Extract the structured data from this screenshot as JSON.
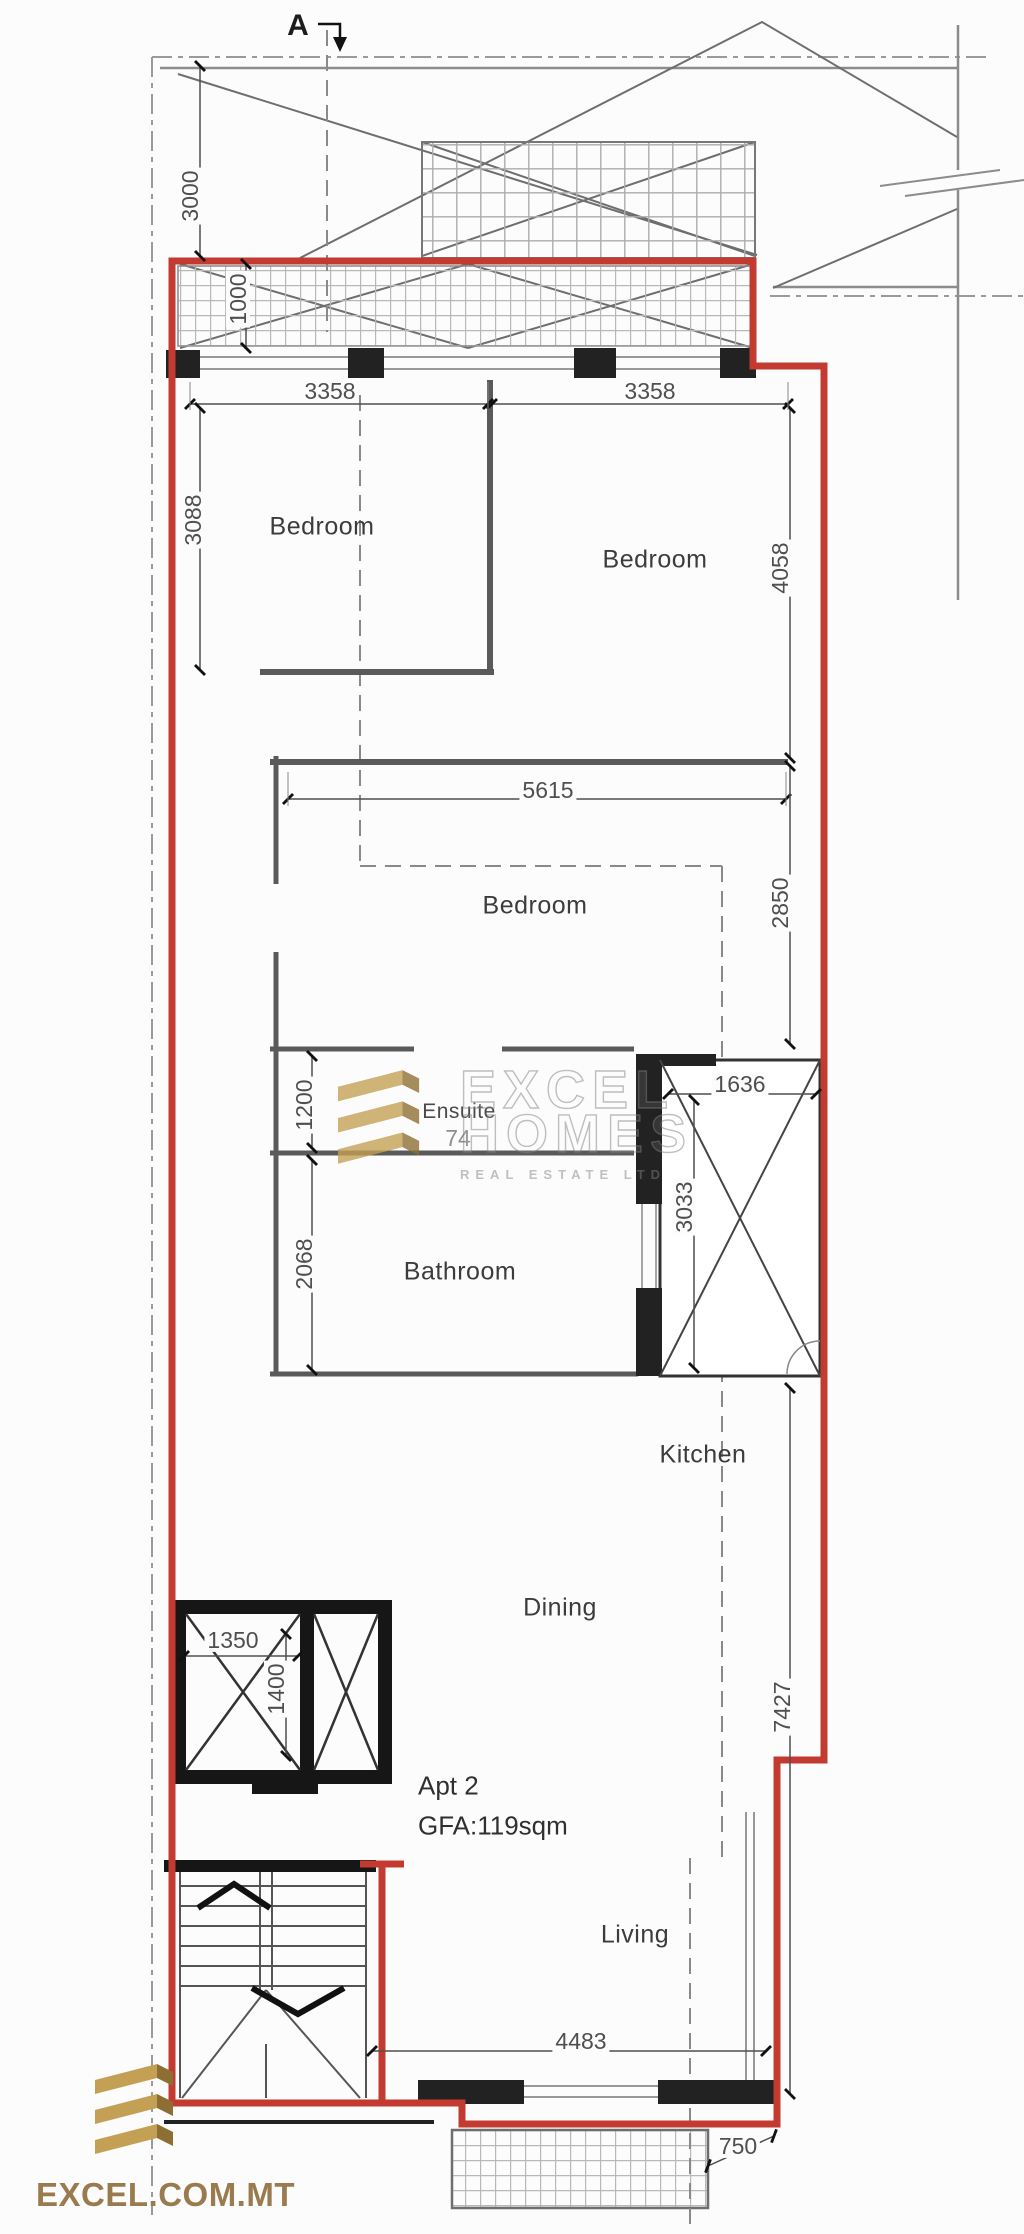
{
  "section_marker": {
    "label": "A"
  },
  "apartment": {
    "name": "Apt 2",
    "gfa": "GFA:119sqm"
  },
  "rooms": {
    "bedroom1": "Bedroom",
    "bedroom2": "Bedroom",
    "bedroom3": "Bedroom",
    "ensuite": "Ensuite",
    "bathroom": "Bathroom",
    "kitchen": "Kitchen",
    "dining": "Dining",
    "living": "Living"
  },
  "dimensions": {
    "front_setback": "3000",
    "front_terrace_depth": "1000",
    "bedroom1_width": "3358",
    "bedroom2_width": "3358",
    "bedroom1_length": "3088",
    "bedroom2_length": "4058",
    "bedroom3_width": "5615",
    "bedroom3_length": "2850",
    "shaft_width": "1636",
    "ensuite_length": "1200",
    "ensuite_partial": "74",
    "bathroom_length": "2068",
    "shaft_length": "3033",
    "lift_width": "1350",
    "lift_length": "1400",
    "living_zone_length": "7427",
    "living_width": "4483",
    "rear_balcony_depth": "750"
  },
  "watermark": {
    "line1": "EXCEL",
    "line2": "HOMES",
    "line3": "REAL ESTATE LTD"
  },
  "brand": {
    "website": "EXCEL.COM.MT"
  },
  "colors": {
    "plan_outline_red": "#c23a30",
    "brand_gold": "#c3a054",
    "brand_gold_dark": "#8d6f33",
    "brand_text": "#9a7b4e"
  }
}
